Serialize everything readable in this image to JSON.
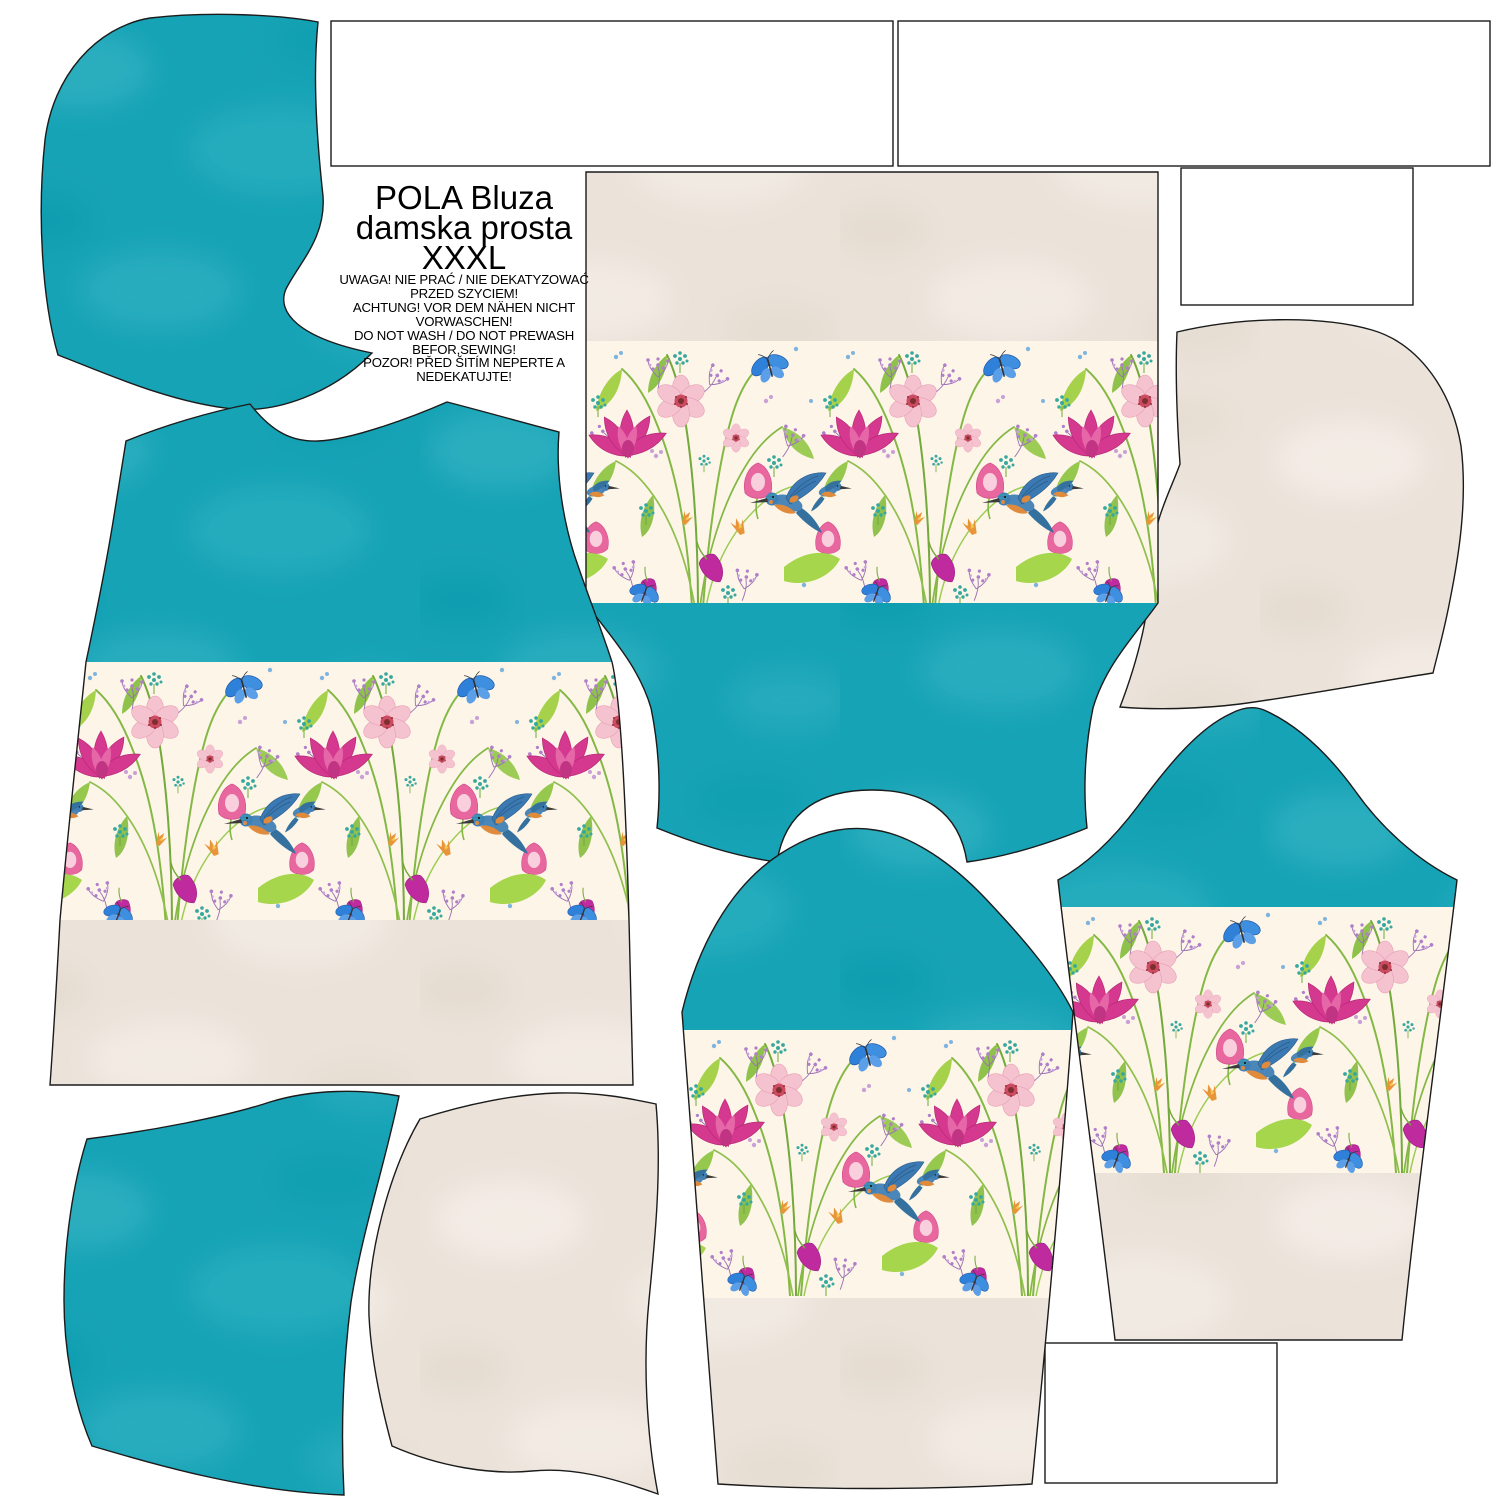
{
  "sheet": {
    "product_title_line1": "POLA Bluza",
    "product_title_line2": "damska prosta",
    "size": "XXXL",
    "warning_lines": [
      "UWAGA! NIE PRAĆ / NIE DEKATYZOWAĆ",
      "PRZED SZYCIEM!",
      "ACHTUNG! VOR DEM NÄHEN NICHT",
      "VORWASCHEN!",
      "DO NOT WASH / DO NOT PREWASH",
      "BEFOR,SEWING!",
      "POZOR! PŘED ŠITÍM NEPERTE A",
      "NEDEKATUJTE!"
    ]
  },
  "palette": {
    "teal-base": "#17a3b6",
    "teal-light": "#3cbac8",
    "teal-dark": "#0e93a6",
    "cream-base": "#ebe3da",
    "cream-light": "#f6f0e9",
    "cream-dark": "#e0d6c9",
    "floral-bg": "#fdf5e7",
    "outline": "#1b1b1b",
    "flower-magenta": "#d5388f",
    "flower-pink": "#f5c3d0",
    "butterfly-blue": "#2f80d8",
    "bird-blue": "#3b79b3",
    "bird-orange": "#e08a3c",
    "leaf-green": "#9ccc55"
  }
}
